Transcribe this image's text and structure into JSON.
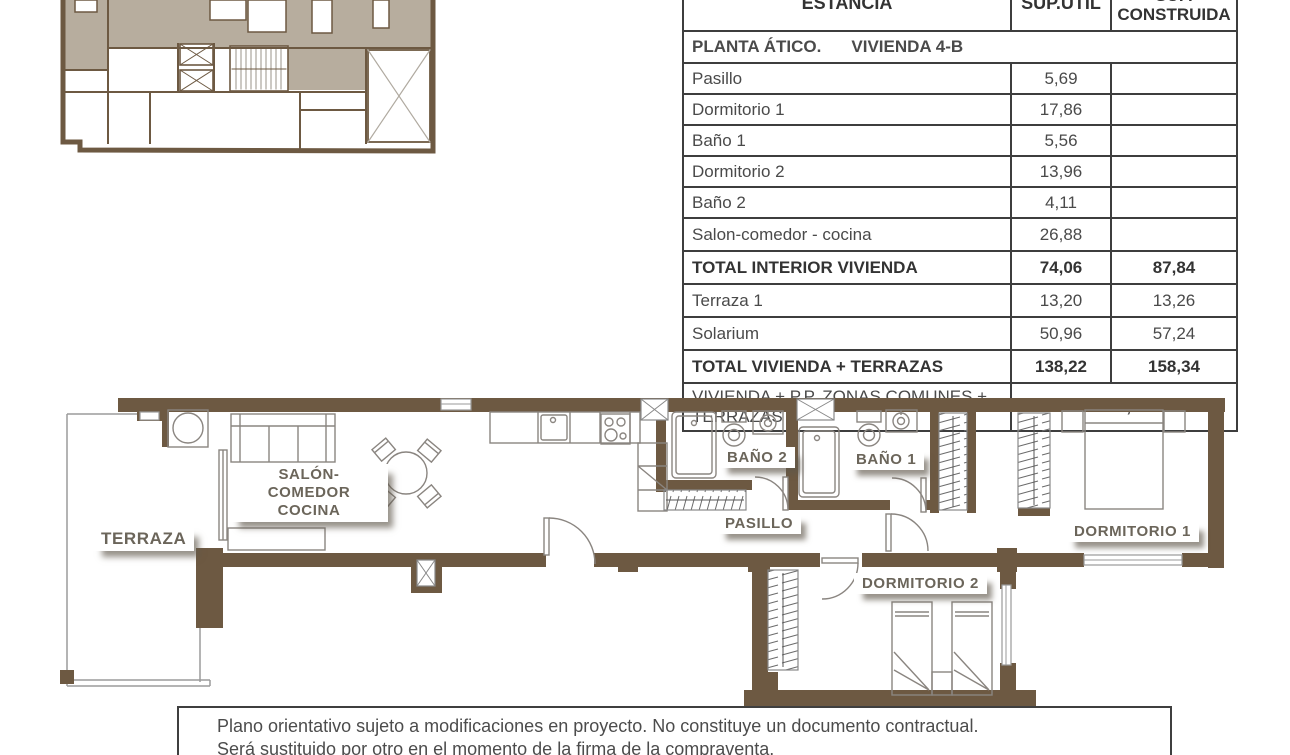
{
  "table": {
    "header": {
      "estancia": "ESTANCIA",
      "sup_util": "SUP.ÚTIL",
      "sup_construida_line1": "SUP.",
      "sup_construida_line2": "CONSTRUIDA"
    },
    "section_title": {
      "left": "PLANTA ÁTICO.",
      "right": "VIVIENDA 4-B"
    },
    "rows": [
      {
        "name": "Pasillo",
        "util": "5,69",
        "construida": ""
      },
      {
        "name": "Dormitorio 1",
        "util": "17,86",
        "construida": ""
      },
      {
        "name": "Baño 1",
        "util": "5,56",
        "construida": ""
      },
      {
        "name": "Dormitorio 2",
        "util": "13,96",
        "construida": ""
      },
      {
        "name": "Baño 2",
        "util": "4,11",
        "construida": ""
      },
      {
        "name": "Salon-comedor - cocina",
        "util": "26,88",
        "construida": ""
      },
      {
        "name": "TOTAL INTERIOR VIVIENDA",
        "util": "74,06",
        "construida": "87,84"
      },
      {
        "name": "Terraza 1",
        "util": "13,20",
        "construida": "13,26"
      },
      {
        "name": "Solarium",
        "util": "50,96",
        "construida": "57,24"
      },
      {
        "name": "TOTAL VIVIENDA + TERRAZAS",
        "util": "138,22",
        "construida": "158,34"
      },
      {
        "name": "VIVIENDA + P.P. ZONAS COMUNES + TERRAZAS",
        "total": "161,83"
      }
    ]
  },
  "floorplan": {
    "labels": {
      "terraza": "TERRAZA",
      "salon_line1": "SALÓN-COMEDOR",
      "salon_line2": "COCINA",
      "bano2": "BAÑO 2",
      "bano1": "BAÑO 1",
      "pasillo": "PASILLO",
      "dormitorio1": "DORMITORIO 1",
      "dormitorio2": "DORMITORIO 2"
    }
  },
  "disclaimer": {
    "line1": "Plano orientativo sujeto a modificaciones en proyecto. No constituye un documento contractual.",
    "line2": "Será sustituido por otro en el momento de la firma de la compraventa."
  },
  "colors": {
    "wall_brown": "#6d5942",
    "keyplan_taupe": "#b7ad9e",
    "label_text": "#6b655a",
    "table_text": "#4a4a4a",
    "furniture_line": "#8a8580"
  }
}
